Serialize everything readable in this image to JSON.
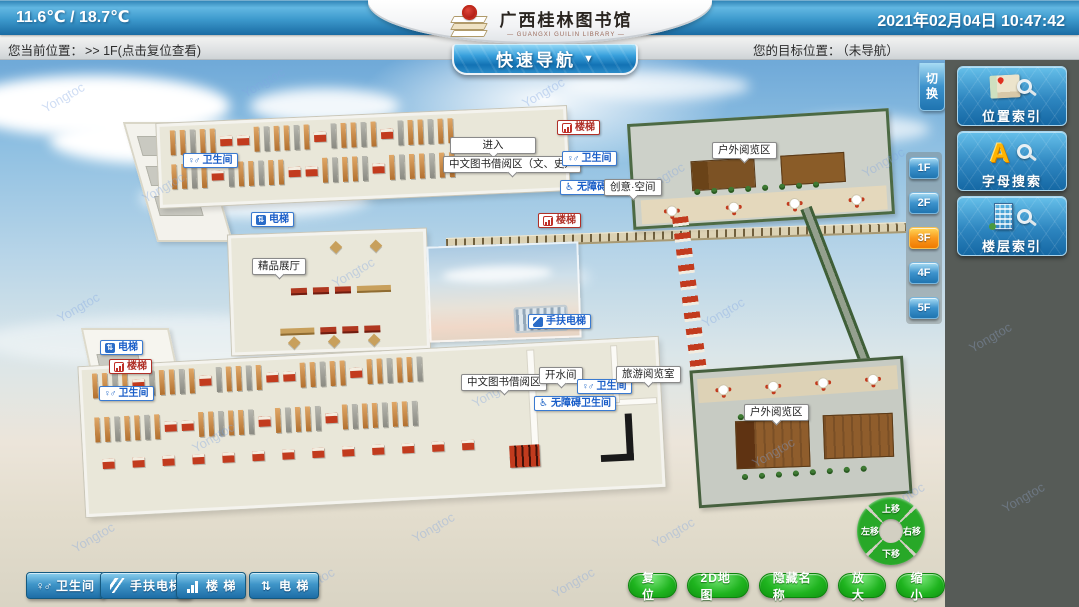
{
  "header": {
    "temperature": "11.6℃ / 18.7℃",
    "datetime": "2021年02月04日  10:47:42",
    "logo": {
      "title": "广西桂林图书馆",
      "subtitle": "— GUANGXI GUILIN LIBRARY —"
    },
    "quick_nav_label": "快速导航",
    "quick_nav_arrow": "▼"
  },
  "statusbar": {
    "current_label": "您当前位置：",
    "current_value": ">> 1F(点击复位查看)",
    "target_label": "您的目标位置：",
    "target_value": "（未导航）"
  },
  "right_panel": {
    "switch_label": "切换",
    "index_buttons": [
      {
        "name": "location-index",
        "label": "位置索引"
      },
      {
        "name": "letter-search",
        "label": "字母搜索",
        "icon_letter": "A"
      },
      {
        "name": "floor-index",
        "label": "楼层索引"
      }
    ],
    "floor_buttons": [
      {
        "label": "1F",
        "active": false
      },
      {
        "label": "2F",
        "active": false
      },
      {
        "label": "3F",
        "active": true
      },
      {
        "label": "4F",
        "active": false
      },
      {
        "label": "5F",
        "active": false
      }
    ]
  },
  "map": {
    "watermark": "Yongtoc",
    "labels": [
      {
        "name": "label-restroom-nw",
        "text": "卫生间",
        "type": "facility",
        "icon": "restroom",
        "x": 183,
        "y": 153
      },
      {
        "name": "label-enter",
        "text": "进入",
        "type": "room-wide",
        "x": 450,
        "y": 137
      },
      {
        "name": "label-chinese-books-lit-hist",
        "text": "中文图书借阅区（文、史）",
        "type": "room",
        "x": 443,
        "y": 156
      },
      {
        "name": "label-stairs-n",
        "text": "楼梯",
        "type": "stairs",
        "icon": "stairs",
        "x": 557,
        "y": 120
      },
      {
        "name": "label-restroom-n",
        "text": "卫生间",
        "type": "facility",
        "icon": "restroom",
        "x": 562,
        "y": 151
      },
      {
        "name": "label-barrier-free-elevator",
        "text": "无障碍电梯",
        "type": "facility",
        "icon": "wheelchair",
        "x": 560,
        "y": 180
      },
      {
        "name": "label-creative-space",
        "text": "创意·空间",
        "type": "room",
        "x": 604,
        "y": 179
      },
      {
        "name": "label-outdoor-reading-n",
        "text": "户外阅览区",
        "type": "room",
        "x": 712,
        "y": 142
      },
      {
        "name": "label-elevator-c",
        "text": "电梯",
        "type": "facility",
        "icon": "elevator",
        "x": 251,
        "y": 212
      },
      {
        "name": "label-stairs-c",
        "text": "楼梯",
        "type": "stairs",
        "icon": "stairs",
        "x": 538,
        "y": 213
      },
      {
        "name": "label-boutique-hall",
        "text": "精品展厅",
        "type": "room",
        "x": 252,
        "y": 258
      },
      {
        "name": "label-escalator-c",
        "text": "手扶电梯",
        "type": "facility",
        "icon": "escalator",
        "x": 528,
        "y": 314
      },
      {
        "name": "label-elevator-sw",
        "text": "电梯",
        "type": "facility",
        "icon": "elevator",
        "x": 100,
        "y": 340
      },
      {
        "name": "label-stairs-sw",
        "text": "楼梯",
        "type": "stairs",
        "icon": "stairs",
        "x": 109,
        "y": 359
      },
      {
        "name": "label-restroom-sw",
        "text": "卫生间",
        "type": "facility",
        "icon": "restroom",
        "x": 99,
        "y": 386
      },
      {
        "name": "label-chinese-books-s",
        "text": "中文图书借阅区",
        "type": "room",
        "x": 461,
        "y": 374
      },
      {
        "name": "label-water-room",
        "text": "开水间",
        "type": "room",
        "x": 539,
        "y": 367
      },
      {
        "name": "label-restroom-s",
        "text": "卫生间",
        "type": "facility",
        "icon": "restroom",
        "x": 577,
        "y": 379
      },
      {
        "name": "label-barrier-free-restroom",
        "text": "无障碍卫生间",
        "type": "facility",
        "icon": "wheelchair",
        "x": 534,
        "y": 396
      },
      {
        "name": "label-travel-reading-room",
        "text": "旅游阅览室",
        "type": "room",
        "x": 616,
        "y": 366
      },
      {
        "name": "label-outdoor-reading-s",
        "text": "户外阅览区",
        "type": "room",
        "x": 744,
        "y": 404
      }
    ]
  },
  "toolbar_left": [
    {
      "name": "restroom",
      "label": "卫生间",
      "icon": "restroom"
    },
    {
      "name": "escalator",
      "label": "手扶电梯",
      "icon": "escalator"
    },
    {
      "name": "stairs",
      "label": "楼 梯",
      "icon": "stairs"
    },
    {
      "name": "elevator",
      "label": "电 梯",
      "icon": "elevator"
    }
  ],
  "toolbar_right": [
    {
      "name": "reset",
      "label": "复位"
    },
    {
      "name": "map-2d",
      "label": "2D地图"
    },
    {
      "name": "hide-names",
      "label": "隐藏名称"
    },
    {
      "name": "zoom-in",
      "label": "放大"
    },
    {
      "name": "zoom-out",
      "label": "缩小"
    }
  ],
  "compass": {
    "up": "上移",
    "down": "下移",
    "left": "左移",
    "right": "右移"
  },
  "colors": {
    "accent_blue": "#2e86c0",
    "active_orange": "#fa9a1e",
    "button_green": "#1fb41f",
    "panel_grey": "#565b57"
  }
}
